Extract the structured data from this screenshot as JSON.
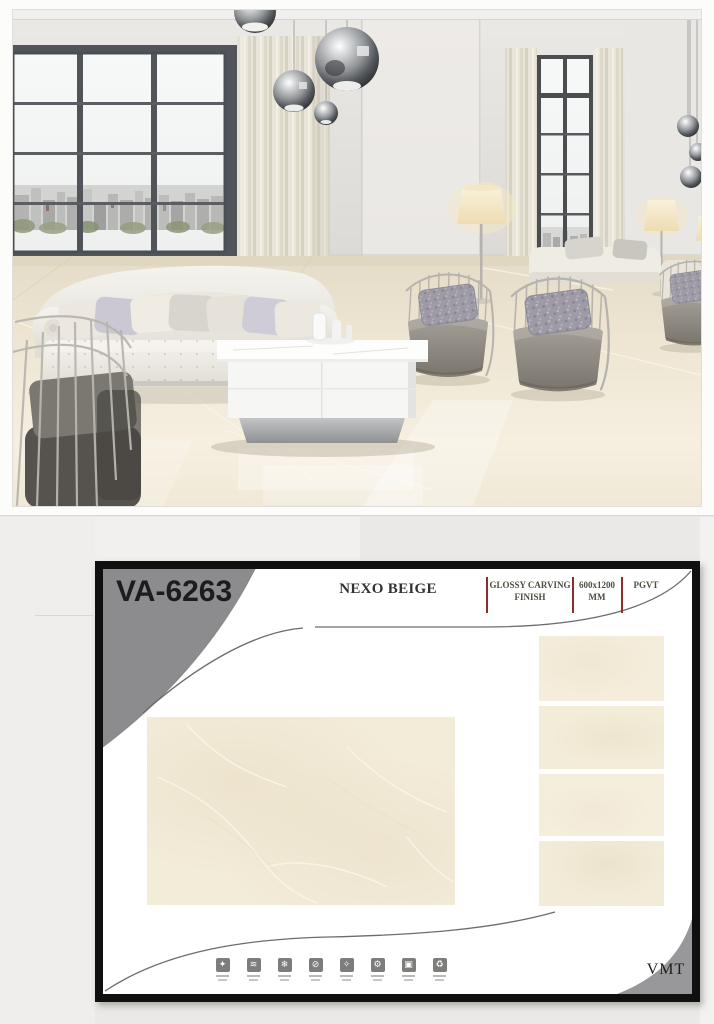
{
  "page": {
    "background": "#e9e8e6"
  },
  "product_card": {
    "code": "VA-6263",
    "name": "NEXO BEIGE",
    "specs": [
      {
        "line1": "GLOSSY CARVING",
        "line2": "FINISH"
      },
      {
        "line1": "600x1200",
        "line2": "MM"
      },
      {
        "line1": "PGVT",
        "line2": ""
      }
    ],
    "brand": "VMT",
    "features": [
      {
        "name": "easy-to-clean",
        "glyph": "✦"
      },
      {
        "name": "water-resistant",
        "glyph": "≋"
      },
      {
        "name": "frost-proof",
        "glyph": "❄"
      },
      {
        "name": "anti-bacterial",
        "glyph": "⊘"
      },
      {
        "name": "stain-resistant",
        "glyph": "✧"
      },
      {
        "name": "scratch-resistant",
        "glyph": "⚙"
      },
      {
        "name": "double-charge",
        "glyph": "▣"
      },
      {
        "name": "eco-friendly",
        "glyph": "♻"
      }
    ],
    "colors": {
      "frame_black": "#101010",
      "banner_gray": "#8c8c8e",
      "accent_red": "#8e2b2b",
      "tile_beige": "#f3ecd9"
    }
  }
}
